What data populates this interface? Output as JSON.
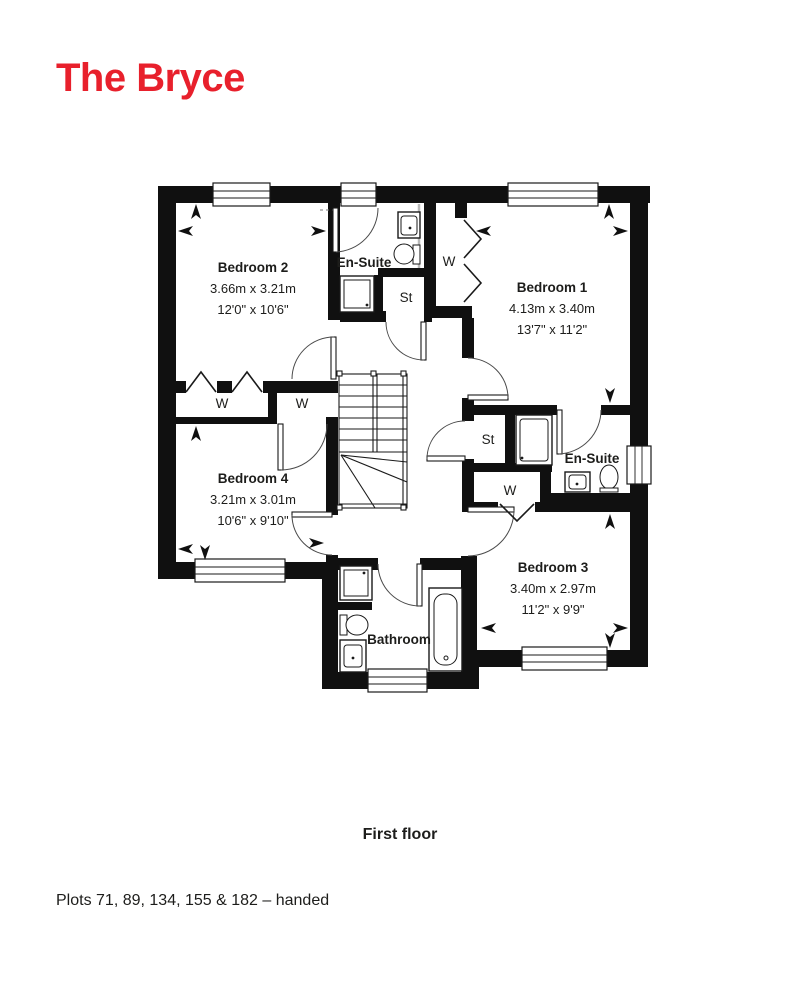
{
  "page": {
    "title": "The Bryce",
    "caption": "First floor",
    "footnote": "Plots 71, 89, 134, 155 & 182 – handed",
    "accent_color": "#e8202c",
    "ink_color": "#1d1d1b"
  },
  "floorplan": {
    "rooms": {
      "bedroom2": {
        "name": "Bedroom 2",
        "metric": "3.66m x 3.21m",
        "imperial": "12'0\" x 10'6\""
      },
      "bedroom1": {
        "name": "Bedroom 1",
        "metric": "4.13m x 3.40m",
        "imperial": "13'7\" x 11'2\""
      },
      "bedroom4": {
        "name": "Bedroom 4",
        "metric": "3.21m x 3.01m",
        "imperial": "10'6\" x 9'10\""
      },
      "bedroom3": {
        "name": "Bedroom 3",
        "metric": "3.40m x 2.97m",
        "imperial": "11'2\" x 9'9\""
      },
      "ensuite1": {
        "name": "En-Suite"
      },
      "ensuite2": {
        "name": "En-Suite"
      },
      "bathroom": {
        "name": "Bathroom"
      }
    },
    "labels": {
      "wardrobe": "W",
      "store": "St"
    }
  }
}
